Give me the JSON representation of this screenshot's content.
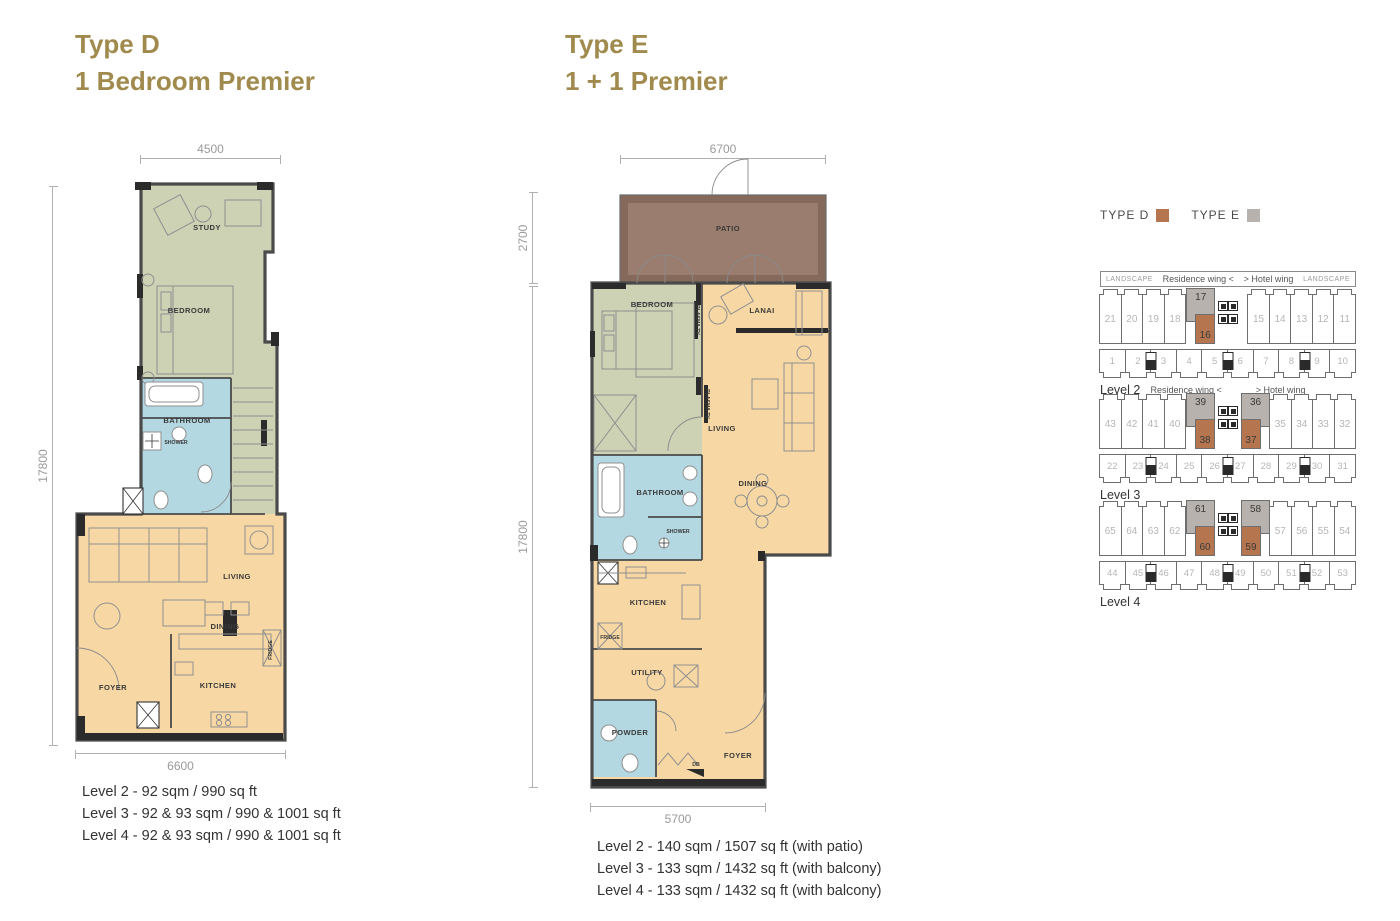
{
  "colors": {
    "gold": "#a08a4d",
    "sage": "#cdd2b4",
    "tan": "#f7d8a4",
    "blue": "#b4d8e2",
    "patio_outer": "#85695b",
    "patio_inner": "#9a7d6e",
    "wall": "#4a4a4a",
    "wall_dark": "#2b2b2b",
    "kp_brown": "#b5764f",
    "kp_gray": "#b7b2ae",
    "kp_border": "#6e6e6e",
    "kp_num": "#b6b6b6",
    "dim": "#b0b0b0",
    "dim_text": "#9a9a9a",
    "text": "#333333"
  },
  "plans": [
    {
      "title_line1": "Type D",
      "title_line2": "1 Bedroom Premier",
      "dims": {
        "top": "4500",
        "left": "17800",
        "bottom": "6600"
      },
      "rooms": {
        "study": "STUDY",
        "bedroom": "BEDROOM",
        "bathroom": "BATHROOM",
        "shower": "SHOWER",
        "living": "LIVING",
        "dining": "DINING",
        "foyer": "FOYER",
        "kitchen": "KITCHEN",
        "fridge": "FRIDGE"
      },
      "levels": [
        "Level 2 - 92 sqm / 990 sq ft",
        "Level 3 - 92 & 93 sqm / 990 & 1001 sq ft",
        "Level 4 - 92 & 93 sqm / 990 & 1001 sq ft"
      ]
    },
    {
      "title_line1": "Type E",
      "title_line2": "1 + 1 Premier",
      "dims": {
        "top": "6700",
        "left_upper": "2700",
        "left": "17800",
        "bottom": "5700"
      },
      "rooms": {
        "patio": "PATIO",
        "bedroom": "BEDROOM",
        "lanai": "LANAI",
        "living": "LIVING",
        "bathroom": "BATHROOM",
        "shower": "SHOWER",
        "dining": "DINING",
        "kitchen": "KITCHEN",
        "fridge": "FRIDGE",
        "utility": "UTILITY",
        "powder": "POWDER",
        "foyer": "FOYER",
        "plasma_tv": "PLASMA TV",
        "db": "DB"
      },
      "levels": [
        "Level 2 - 140 sqm / 1507 sq ft (with patio)",
        "Level 3 - 133 sqm / 1432 sq ft (with balcony)",
        "Level 4 - 133 sqm / 1432 sq ft (with balcony)"
      ]
    }
  ],
  "legend": {
    "type_d": {
      "label": "TYPE D",
      "color": "#b5764f"
    },
    "type_e": {
      "label": "TYPE E",
      "color": "#b7b2ae"
    }
  },
  "key_plans": [
    {
      "label": "Level 2",
      "header": {
        "landscape_left": "LANDSCAPE",
        "wing_left": "Residence wing  <",
        "wing_right": ">  Hotel wing",
        "landscape_right": "LANDSCAPE"
      },
      "top_left": [
        "21",
        "20",
        "19",
        "18"
      ],
      "left_pair": {
        "gray": "17",
        "brown": "16"
      },
      "top_right": [
        "15",
        "14",
        "13",
        "12",
        "11"
      ],
      "bottom": [
        "1",
        "2",
        "3",
        "4",
        "5",
        "6",
        "7",
        "8",
        "9",
        "10"
      ]
    },
    {
      "label": "Level 3",
      "header": {
        "wing_left": "Residence wing  <",
        "wing_right": ">  Hotel wing"
      },
      "top_left": [
        "43",
        "42",
        "41",
        "40"
      ],
      "left_pair": {
        "gray": "39",
        "brown": "38"
      },
      "right_pair": {
        "gray": "36",
        "brown": "37"
      },
      "top_right": [
        "35",
        "34",
        "33",
        "32"
      ],
      "bottom": [
        "22",
        "23",
        "24",
        "25",
        "26",
        "27",
        "28",
        "29",
        "30",
        "31"
      ]
    },
    {
      "label": "Level 4",
      "top_left": [
        "65",
        "64",
        "63",
        "62"
      ],
      "left_pair": {
        "gray": "61",
        "brown": "60"
      },
      "right_pair": {
        "gray": "58",
        "brown": "59"
      },
      "top_right": [
        "57",
        "56",
        "55",
        "54"
      ],
      "bottom": [
        "44",
        "45",
        "46",
        "47",
        "48",
        "49",
        "50",
        "51",
        "52",
        "53"
      ]
    }
  ]
}
